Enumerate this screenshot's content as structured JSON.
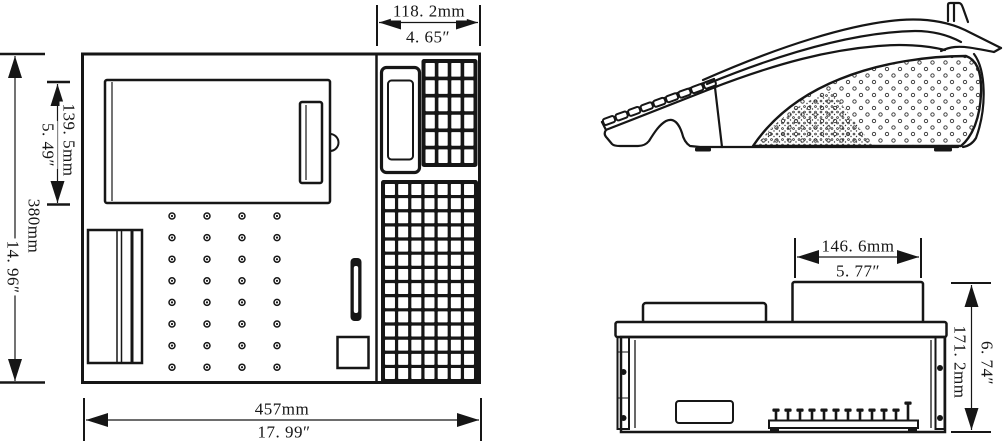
{
  "drawing": {
    "type": "technical-dimension-drawing",
    "subject": "electronic-cash-register",
    "line_color": "#161616",
    "background_color": "#ffffff"
  },
  "front_view": {
    "dim_keypad_width": {
      "mm": "118. 2mm",
      "inch": "4. 65″"
    },
    "dim_printer_height": {
      "mm": "139. 5mm",
      "inch": "5. 49″"
    },
    "dim_total_height": {
      "mm": "380mm",
      "inch": "14. 96″"
    },
    "dim_total_width": {
      "mm": "457mm",
      "inch": "17. 99″"
    },
    "top_keypad": {
      "cols": 4,
      "rows": 6
    },
    "main_keypad": {
      "cols": 7,
      "rows": 14
    },
    "speaker_dot_grid": {
      "cols": 4,
      "rows": 8
    }
  },
  "rear_view": {
    "dim_top_block_width": {
      "mm": "146. 6mm",
      "inch": "5. 77″"
    },
    "dim_total_height": {
      "mm": "171. 2mm",
      "inch": "6. 74″"
    },
    "terminal_pin_count": 12
  },
  "side_view": {
    "key_count": 9
  }
}
